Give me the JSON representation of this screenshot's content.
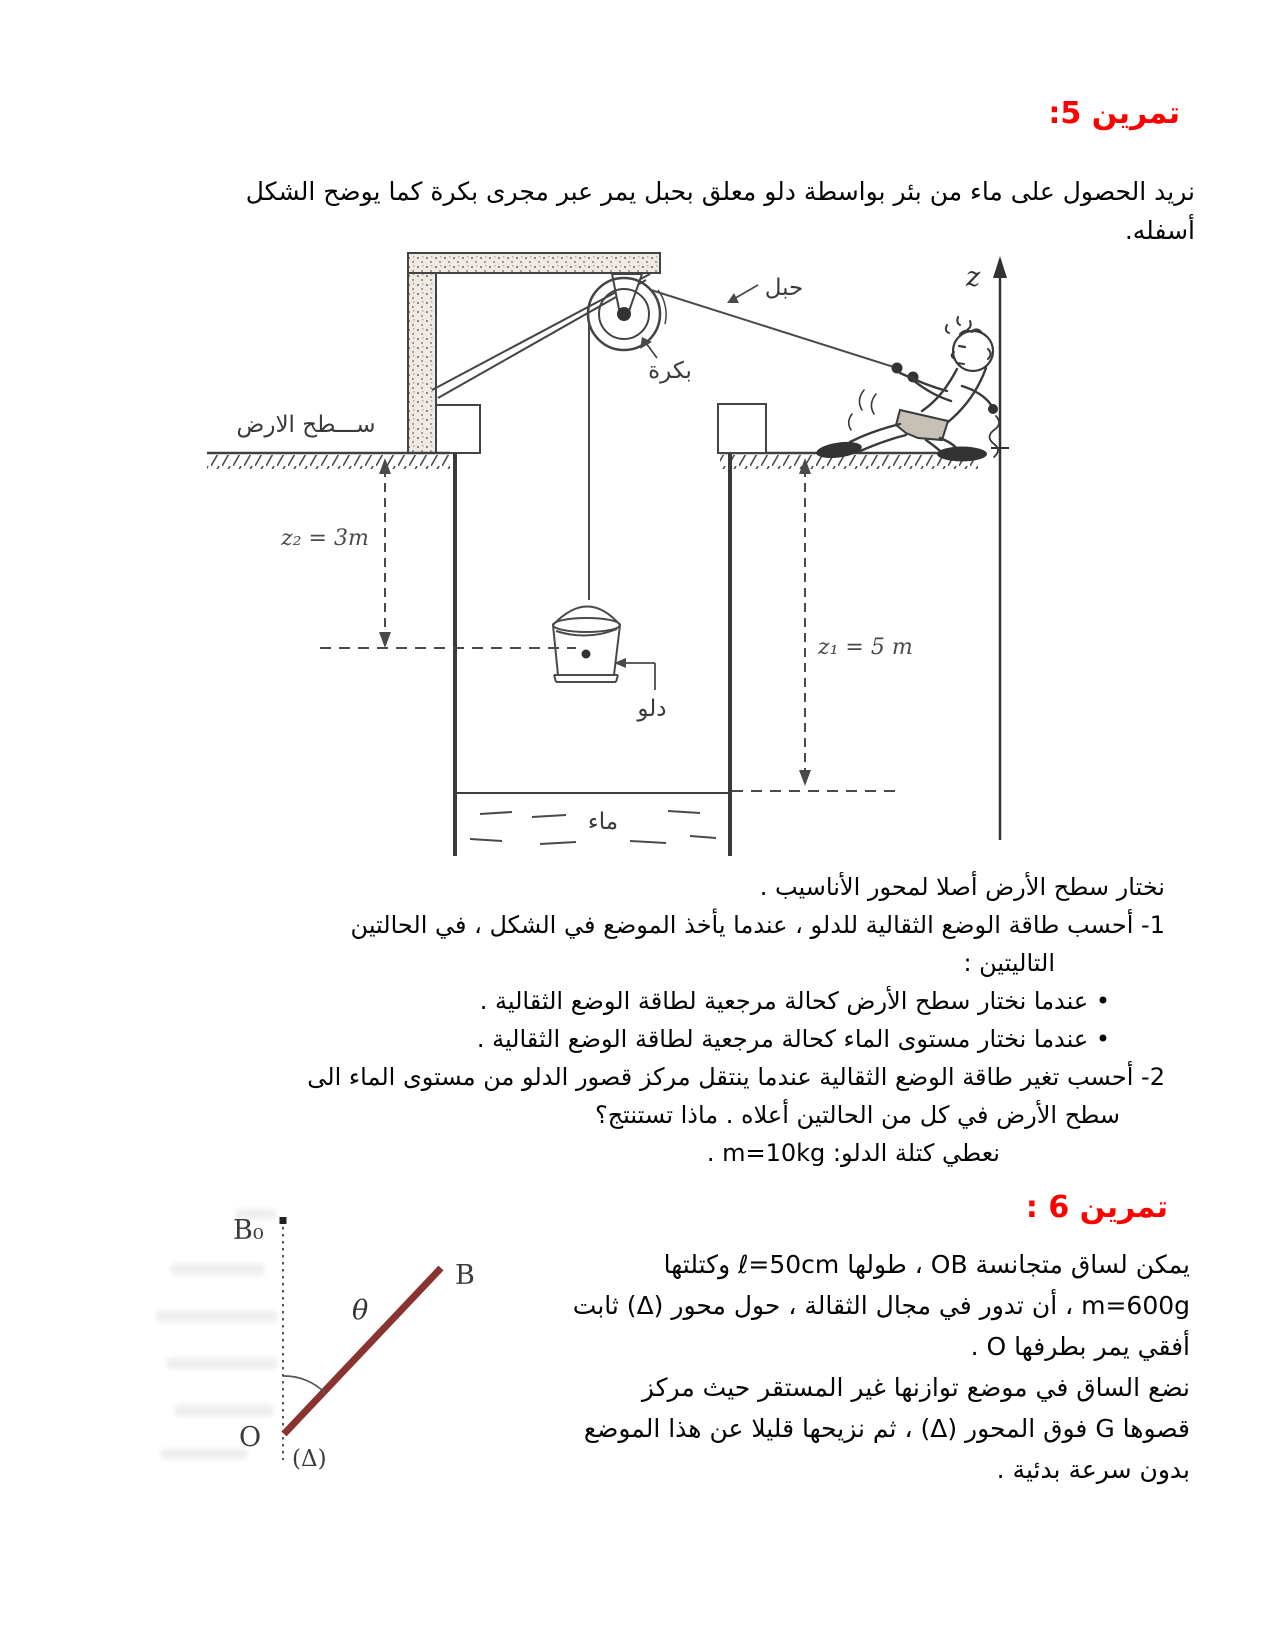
{
  "page": {
    "accent_red": "#ff0000",
    "ink": "#050505",
    "sketch_ink": "#444444",
    "rod_color": "#8a3432"
  },
  "exercise5": {
    "title": "تمرين 5:",
    "intro": [
      "نريد الحصول على ماء من بئر بواسطة دلو معلق بحبل يمر عبر مجرى بكرة كما يوضح الشكل",
      "أسفله."
    ],
    "figure_labels": {
      "rope": "حبل",
      "pulley": "بكرة",
      "ground_surface": "ســـطح الارض",
      "z_axis": "z",
      "z2": "z₂ = 3m",
      "z1": "z₁ = 5 m",
      "bucket": "دلو",
      "water": "ماء"
    },
    "body": [
      "نختار سطح الأرض أصلا لمحور الأناسيب .",
      "1- أحسب طاقة الوضع الثقالية للدلو ، عندما يأخذ الموضع في الشكل ، في الحالتين",
      "التاليتين :",
      "•  عندما نختار سطح الأرض كحالة مرجعية لطاقة الوضع الثقالية .",
      "•  عندما نختار مستوى الماء كحالة مرجعية لطاقة الوضع الثقالية .",
      "2- أحسب تغير طاقة  الوضع الثقالية عندما ينتقل مركز قصور الدلو من مستوى الماء الى",
      "سطح الأرض في كل من الحالتين أعلاه . ماذا تستنتج؟",
      "نعطي كتلة الدلو: m=10kg ."
    ]
  },
  "exercise6": {
    "title": "تمرين 6 :",
    "lines": [
      "يمكن لساق متجانسة OB ، طولها ℓ=50cm وكتلتها",
      "m=600g ، أن تدور في مجال الثقالة ، حول محور (Δ) ثابت",
      "أفقي يمر بطرفها O .",
      "نضع الساق في موضع توازنها غير المستقر حيث مركز",
      "قصوها G فوق المحور (Δ) ، ثم نزيحها قليلا عن هذا الموضع",
      "بدون سرعة بدئية ."
    ],
    "diagram_labels": {
      "b0": "B₀",
      "b": "B",
      "theta": "θ",
      "o": "O",
      "delta": "(Δ)"
    }
  }
}
